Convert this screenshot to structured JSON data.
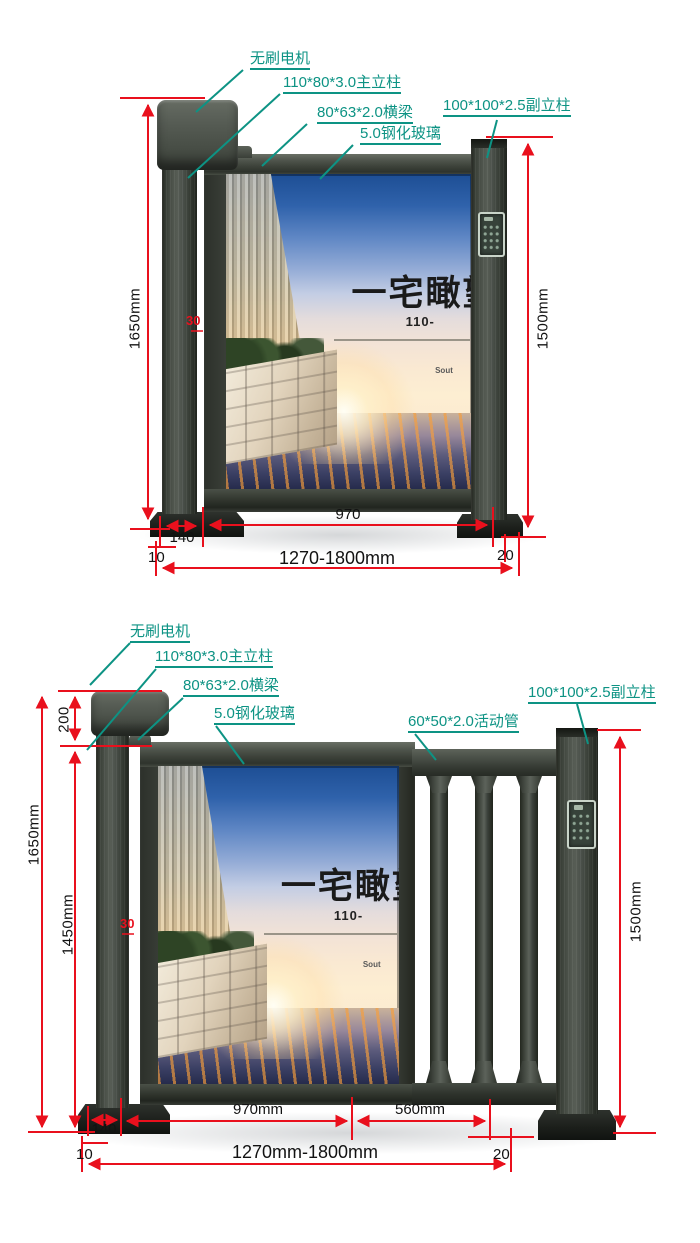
{
  "colors": {
    "callout": "#0d9384",
    "dimension": "#e9101d",
    "metal": "#3c423d"
  },
  "diagram_top": {
    "callouts": {
      "motor": "无刷电机",
      "main_post": "110*80*3.0主立柱",
      "beam": "80*63*2.0横梁",
      "glass": "5.0钢化玻璃",
      "sub_post": "100*100*2.5副立柱"
    },
    "dimensions": {
      "total_height": "1650mm",
      "sub_post_height": "1500mm",
      "gap": "30",
      "door_width": "970",
      "post_width": "140",
      "left_offset": "10",
      "total_width": "1270-1800mm",
      "right_offset": "20"
    },
    "poster": {
      "title": "一宅瞰望",
      "subtitle": "110-",
      "brand": "Sout"
    }
  },
  "diagram_bottom": {
    "callouts": {
      "motor": "无刷电机",
      "main_post": "110*80*3.0主立柱",
      "beam": "80*63*2.0横梁",
      "glass": "5.0钢化玻璃",
      "tube": "60*50*2.0活动管",
      "sub_post": "100*100*2.5副立柱"
    },
    "dimensions": {
      "cap_height": "200",
      "total_height": "1650mm",
      "door_height": "1450mm",
      "sub_post_height": "1500mm",
      "gap": "30",
      "door_width": "970mm",
      "railing_width": "560mm",
      "post_width": "140",
      "left_offset": "10",
      "total_width": "1270mm-1800mm",
      "right_offset": "20"
    },
    "poster": {
      "title": "一宅瞰望",
      "subtitle": "110-",
      "brand": "Sout"
    }
  }
}
